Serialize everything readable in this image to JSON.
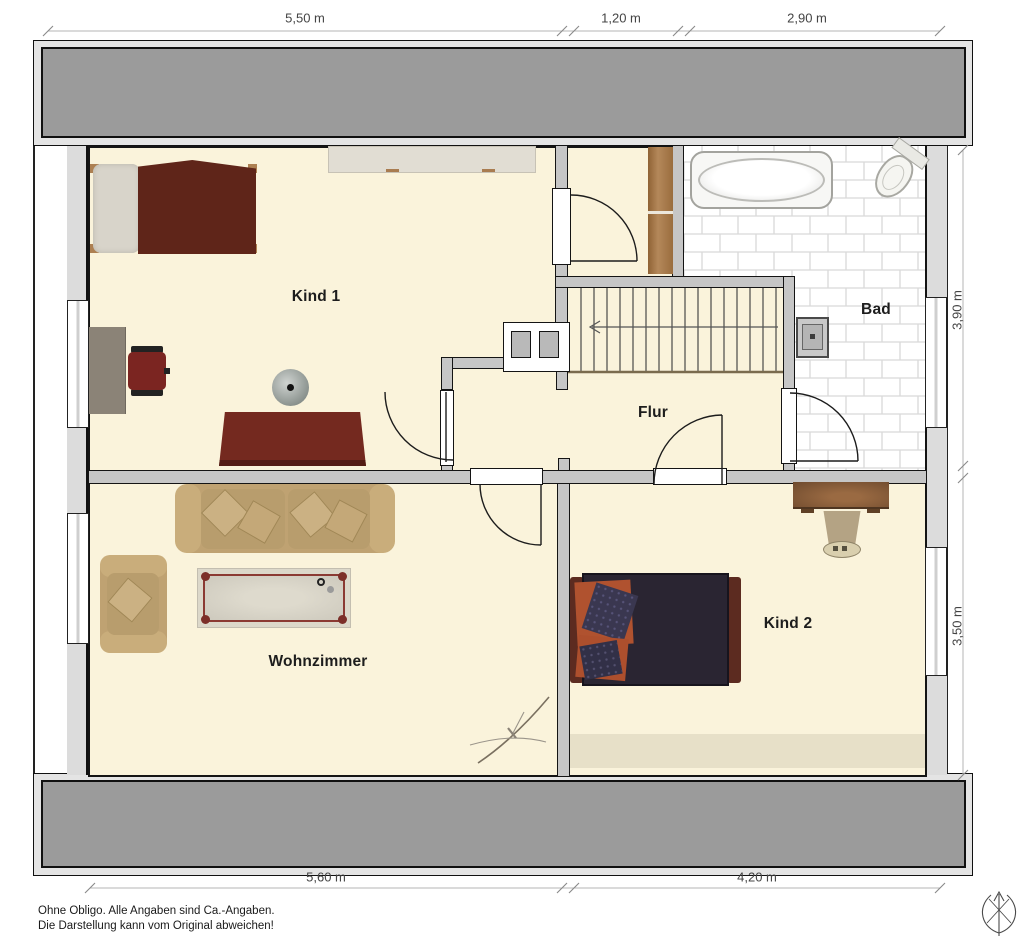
{
  "plan": {
    "rooms": {
      "kind1": {
        "label": "Kind 1"
      },
      "bad": {
        "label": "Bad"
      },
      "flur": {
        "label": "Flur"
      },
      "wohnzimmer": {
        "label": "Wohnzimmer"
      },
      "kind2": {
        "label": "Kind 2"
      }
    },
    "dimensions": {
      "top": [
        {
          "label": "5,50 m"
        },
        {
          "label": "1,20 m"
        },
        {
          "label": "2,90 m"
        }
      ],
      "right": [
        {
          "label": "3,90 m"
        },
        {
          "label": "3,50 m"
        }
      ],
      "bottom": [
        {
          "label": "5,60 m"
        },
        {
          "label": "4,20 m"
        }
      ]
    },
    "disclaimer": {
      "line1": "Ohne Obligo. Alle Angaben sind Ca.-Angaben.",
      "line2": "Die Darstellung kann vom Original abweichen!"
    },
    "colors": {
      "floor": "#FAF3DB",
      "wall_gray": "#C6C6C6",
      "roof_band": "#9B9B9B",
      "tile_grout": "#D9D9D9",
      "wood_shelf": "#A87A4E",
      "bed1_blanket": "#5F2519",
      "sofa_tan": "#BFA272",
      "bed2_blanket": "#2A2532",
      "table_frame_red": "#8B3A33"
    }
  }
}
